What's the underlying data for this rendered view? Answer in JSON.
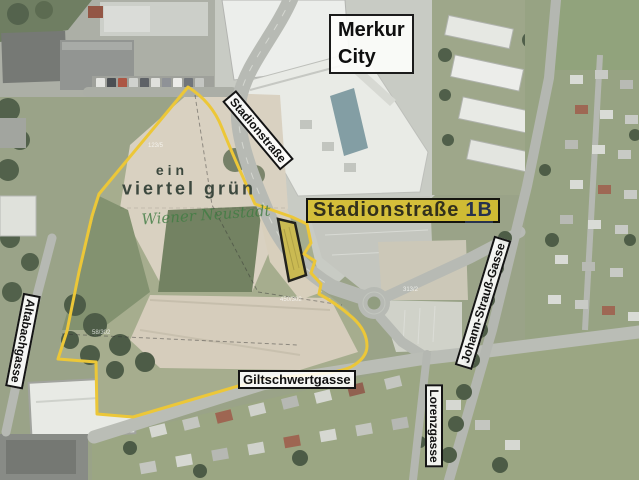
{
  "map": {
    "region_labels": {
      "merkur_city": {
        "lines": [
          "Merkur",
          "City"
        ]
      },
      "site_label": {
        "street": "Stadionstraße",
        "number": "1B"
      }
    },
    "street_labels": {
      "stadionstrasse": "Stadionstraße",
      "giltschwertgasse": "Giltschwertgasse",
      "johann_strauss_gasse": "Johann-Strauß-Gasse",
      "lorenzgasse": "Lorenzgasse",
      "altabachgasse": "Altabachgasse"
    },
    "project_logo": {
      "line1": "ein",
      "line2": "viertel grün",
      "script": "Wiener Neustadt"
    },
    "parcel_numbers": [
      {
        "text": "123/5"
      },
      {
        "text": "450/302"
      },
      {
        "text": "58/302"
      },
      {
        "text": "313/2"
      }
    ],
    "colors": {
      "boundary-yellow": "#edc62f",
      "parcel-fill": "#c9b84a",
      "site-label-bg": "#d6be28",
      "site-label-text": "#32301c",
      "site-number-text": "#27324e",
      "label-bg": "#ffffff",
      "label-border": "#141414",
      "label-text": "#111111",
      "logo-green": "#3c483e",
      "script-green": "#3f7c42"
    }
  }
}
